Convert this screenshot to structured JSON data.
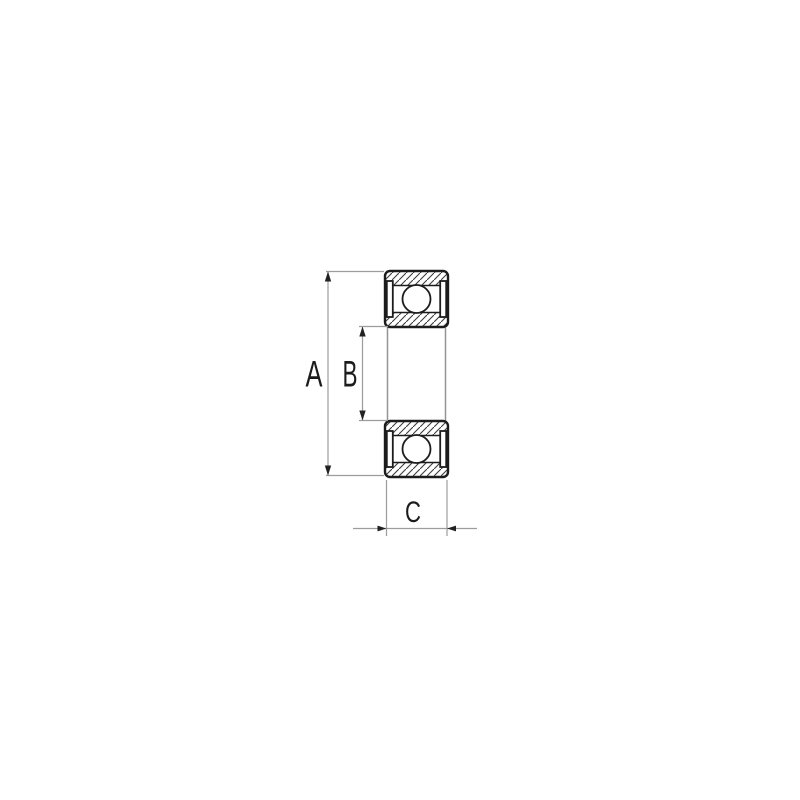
{
  "page": {
    "background": "#ffffff"
  },
  "drawing": {
    "kind": "ball-bearing cross-section technical drawing",
    "dimension_labels": [
      "A",
      "B",
      "C"
    ]
  },
  "dimensions": {
    "a": {
      "label": "A"
    },
    "b": {
      "label": "B"
    },
    "c": {
      "label": "C"
    }
  },
  "colors": {
    "background": "#ffffff",
    "outline": "#1c1c1c",
    "hatch": "#3c3c3c",
    "dimension_line": "#9c9c9c",
    "arrow": "#222222",
    "label_text": "#1c1c1c"
  }
}
